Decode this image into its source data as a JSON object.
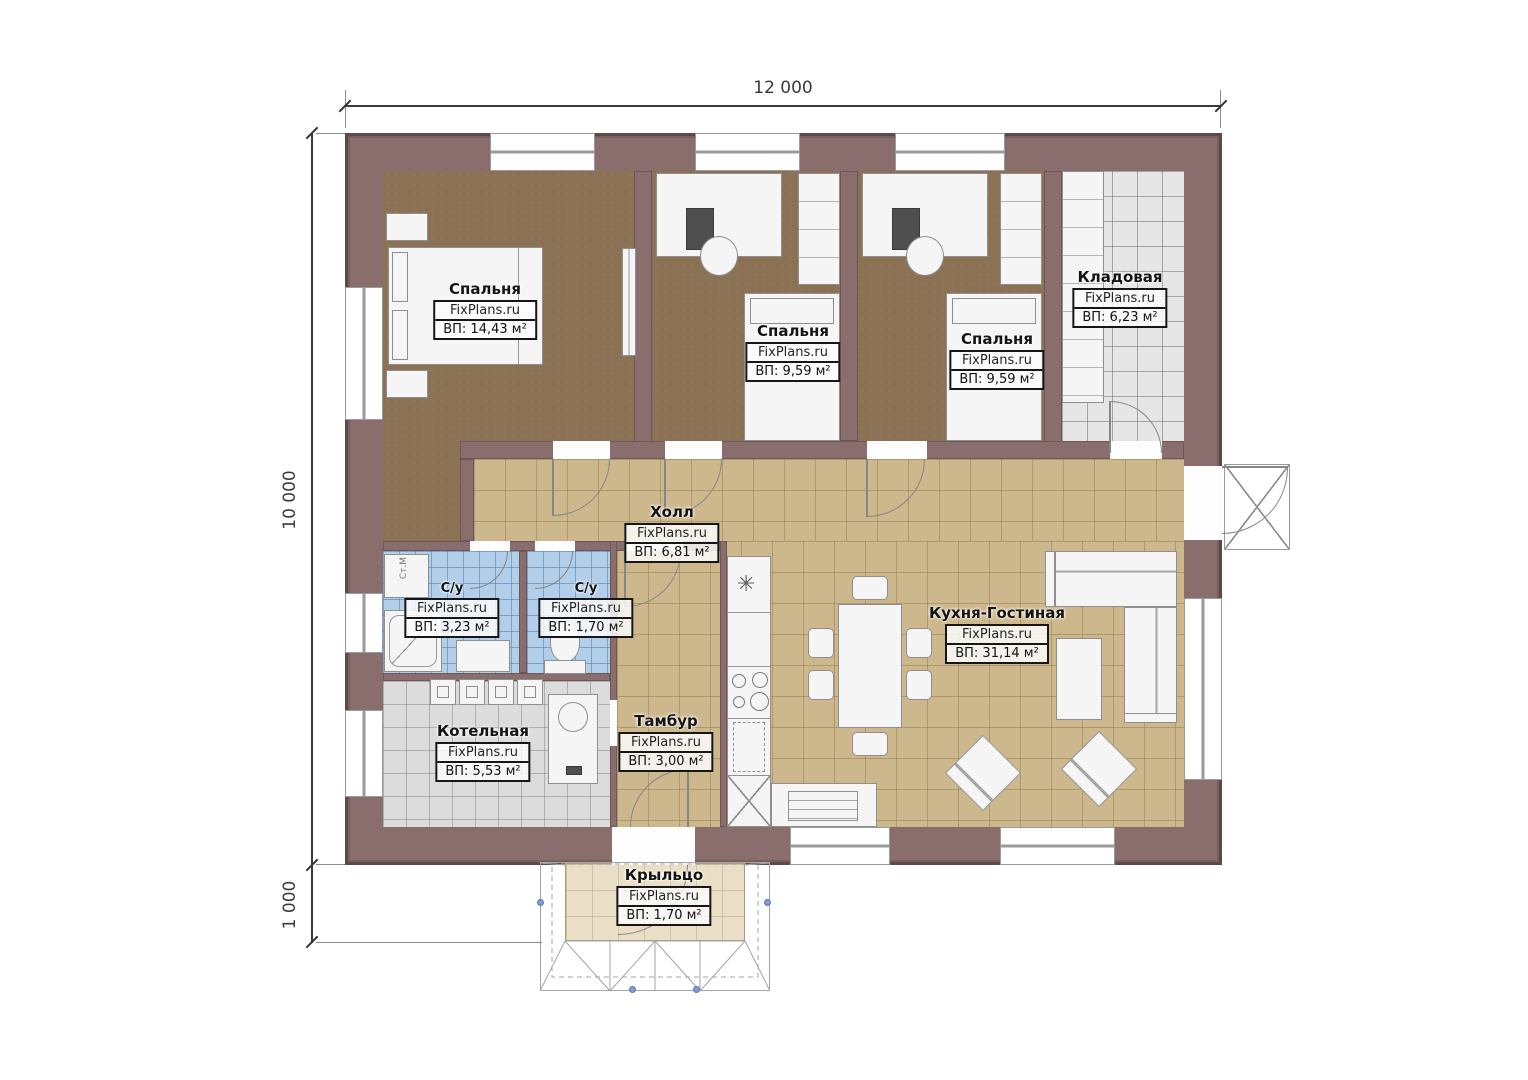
{
  "plan": {
    "dimensions": {
      "width": "12 000",
      "height": "10 000",
      "porch_depth": "1 000"
    },
    "watermark": "FixPlans.ru",
    "rooms": {
      "bedroom1": {
        "name": "Спальня",
        "area": "ВП: 14,43 м²"
      },
      "bedroom2": {
        "name": "Спальня",
        "area": "ВП: 9,59 м²"
      },
      "bedroom3": {
        "name": "Спальня",
        "area": "ВП: 9,59 м²"
      },
      "storage": {
        "name": "Кладовая",
        "area": "ВП: 6,23 м²"
      },
      "hall": {
        "name": "Холл",
        "area": "ВП: 6,81 м²"
      },
      "bathroom1": {
        "name": "С/у",
        "area": "ВП: 3,23 м²"
      },
      "bathroom2": {
        "name": "С/у",
        "area": "ВП: 1,70 м²"
      },
      "boiler": {
        "name": "Котельная",
        "area": "ВП: 5,53 м²"
      },
      "vestibule": {
        "name": "Тамбур",
        "area": "ВП: 3,00 м²"
      },
      "kitchen_living": {
        "name": "Кухня-Гостиная",
        "area": "ВП: 31,14 м²"
      },
      "porch": {
        "name": "Крыльцо",
        "area": "ВП: 1,70 м²"
      }
    },
    "annotations": {
      "washing_machine": "Ст.М"
    },
    "icons": {
      "sink": "✳"
    },
    "colors": {
      "wall": "#8a6e6e",
      "bedroom_floor": "#8c7254",
      "tile_tan": "#cdb88e",
      "tile_blue": "#b3cee9",
      "tile_gray": "#dcdcdc",
      "tile_storage": "#e6e6e6",
      "porch_floor": "#eadfc6",
      "marker_dot": "#7d9fd0"
    }
  }
}
